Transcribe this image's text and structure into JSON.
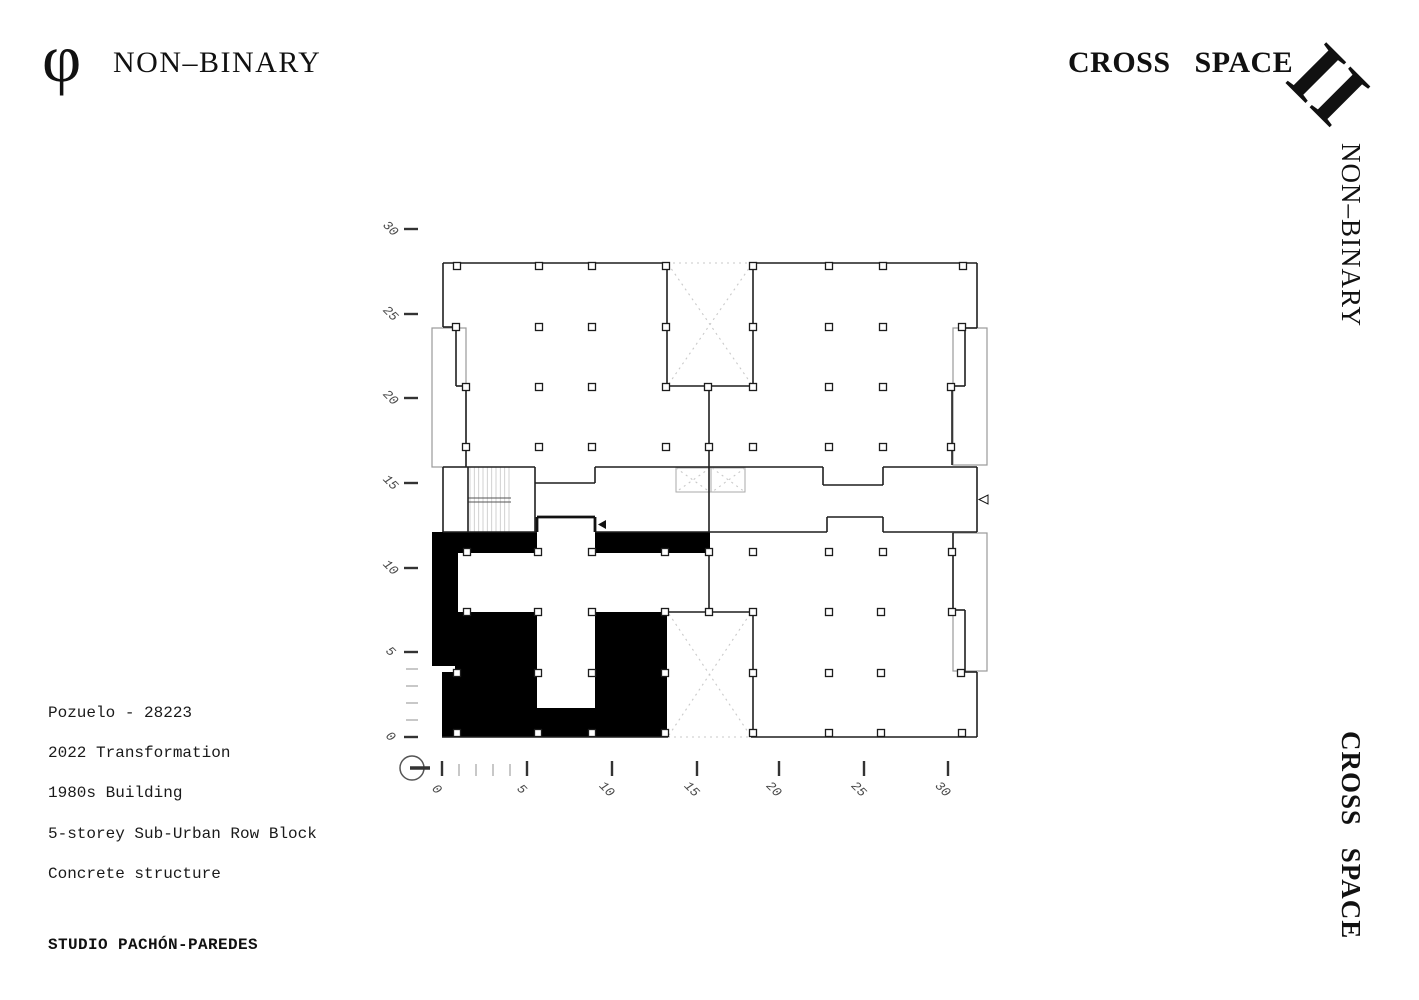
{
  "page": {
    "width": 1419,
    "height": 1000,
    "background": "#ffffff"
  },
  "branding": {
    "logo_glyph": "φ",
    "title_left": "NON–BINARY",
    "title_right": "CROSS SPACE",
    "floor_numeral": "II",
    "side_top": "NON–BINARY",
    "side_bottom": "CROSS SPACE"
  },
  "project_info": {
    "lines": [
      "Pozuelo - 28223",
      "2022 Transformation",
      "1980s Building",
      "5-storey Sub-Urban Row Block",
      "Concrete structure"
    ],
    "studio": "STUDIO PACHÓN-PAREDES"
  },
  "colors": {
    "wall_dark": "#1f1f1f",
    "fill_black": "#000000",
    "bay_gray": "#9a9a9a",
    "light_gray": "#c9c9c9",
    "hatch_gray": "#cccccc",
    "tick_dark": "#333333",
    "tick_minor": "#bbbbbb",
    "label_gray": "#4a4a4a"
  },
  "axes": {
    "left": {
      "values": [
        "30",
        "25",
        "20",
        "15",
        "10",
        "5",
        "0"
      ],
      "y": [
        229,
        314,
        398,
        483,
        568,
        652,
        737
      ],
      "minor_y": [
        669,
        686,
        703,
        720
      ],
      "dash_x1": 404,
      "dash_x2": 418,
      "label_x": 390
    },
    "bottom": {
      "values": [
        "0",
        "5",
        "10",
        "15",
        "20",
        "25",
        "30"
      ],
      "x": [
        442,
        527,
        612,
        697,
        779,
        864,
        948
      ],
      "minor_x": [
        459,
        476,
        493,
        510
      ],
      "dash_y1": 761,
      "dash_y2": 776,
      "label_y": 793
    }
  },
  "plan": {
    "fills_black": [
      [
        432,
        532,
        26,
        134
      ],
      [
        443,
        532,
        94,
        21
      ],
      [
        595,
        532,
        115,
        21
      ],
      [
        455,
        612,
        82,
        60
      ],
      [
        595,
        612,
        72,
        60
      ],
      [
        442,
        672,
        95,
        36
      ],
      [
        595,
        672,
        72,
        36
      ],
      [
        442,
        708,
        225,
        29
      ]
    ],
    "bay_rects": [
      [
        432,
        328,
        34,
        139
      ],
      [
        953,
        328,
        34,
        137
      ],
      [
        953,
        533,
        34,
        138
      ]
    ],
    "elevator": {
      "rect": [
        676,
        468,
        69,
        24
      ],
      "mid_x": 711
    },
    "stairs": {
      "x1": 470,
      "x2": 509,
      "n": 10,
      "y1": 467,
      "y2": 532,
      "landing_y": [
        498,
        502
      ],
      "edge_x": 468,
      "right_x": 511
    },
    "walls_dark": [
      [
        443,
        263,
        667,
        263
      ],
      [
        753,
        263,
        977,
        263
      ],
      [
        443,
        263,
        443,
        327
      ],
      [
        443,
        327,
        456,
        327
      ],
      [
        456,
        327,
        456,
        386
      ],
      [
        456,
        386,
        466,
        386
      ],
      [
        466,
        386,
        466,
        467
      ],
      [
        977,
        263,
        977,
        328
      ],
      [
        977,
        328,
        965,
        328
      ],
      [
        965,
        328,
        965,
        386
      ],
      [
        965,
        386,
        952,
        386
      ],
      [
        952,
        386,
        952,
        465
      ],
      [
        667,
        263,
        667,
        386
      ],
      [
        753,
        263,
        753,
        386
      ],
      [
        667,
        386,
        753,
        386
      ],
      [
        709,
        386,
        709,
        532
      ],
      [
        443,
        467,
        535,
        467
      ],
      [
        535,
        467,
        535,
        532
      ],
      [
        535,
        483,
        595,
        483
      ],
      [
        595,
        467,
        595,
        483
      ],
      [
        595,
        467,
        823,
        467
      ],
      [
        823,
        467,
        823,
        485
      ],
      [
        823,
        485,
        883,
        485
      ],
      [
        883,
        467,
        883,
        485
      ],
      [
        883,
        467,
        977,
        467
      ],
      [
        443,
        467,
        443,
        532
      ],
      [
        977,
        467,
        977,
        532
      ],
      [
        468,
        467,
        468,
        532
      ],
      [
        443,
        532,
        537,
        532
      ],
      [
        595,
        532,
        827,
        532
      ],
      [
        883,
        532,
        977,
        532
      ],
      [
        827,
        532,
        827,
        517
      ],
      [
        827,
        517,
        883,
        517
      ],
      [
        883,
        517,
        883,
        532
      ],
      [
        709,
        553,
        709,
        612
      ],
      [
        667,
        612,
        753,
        612
      ],
      [
        753,
        612,
        753,
        737
      ],
      [
        751,
        737,
        977,
        737
      ],
      [
        953,
        533,
        953,
        610
      ],
      [
        953,
        610,
        965,
        610
      ],
      [
        965,
        610,
        965,
        672
      ],
      [
        965,
        672,
        977,
        672
      ],
      [
        977,
        672,
        977,
        737
      ],
      [
        442,
        737,
        668,
        737
      ]
    ],
    "walls_thick": [
      [
        537,
        532,
        537,
        517
      ],
      [
        537,
        517,
        595,
        517
      ],
      [
        595,
        517,
        595,
        532
      ]
    ],
    "landing_lines": [
      [
        468,
        498,
        511,
        498
      ],
      [
        468,
        502,
        511,
        502
      ]
    ],
    "dotted_lines": [
      [
        667,
        263,
        753,
        263
      ],
      [
        668,
        264,
        752,
        385
      ],
      [
        752,
        264,
        668,
        385
      ],
      [
        669,
        614,
        750,
        735
      ],
      [
        750,
        614,
        669,
        735
      ],
      [
        668,
        737,
        751,
        737
      ],
      [
        676,
        468,
        710,
        492
      ],
      [
        710,
        468,
        676,
        492
      ],
      [
        712,
        468,
        745,
        492
      ],
      [
        745,
        468,
        712,
        492
      ]
    ],
    "column_rows": [
      {
        "y": 266,
        "x": [
          457,
          539,
          592,
          666,
          753,
          829,
          883,
          963
        ]
      },
      {
        "y": 327,
        "x": [
          456,
          539,
          592,
          666,
          753,
          829,
          883,
          962
        ]
      },
      {
        "y": 387,
        "x": [
          466,
          539,
          592,
          666,
          708,
          753,
          829,
          883,
          951
        ]
      },
      {
        "y": 447,
        "x": [
          466,
          539,
          592,
          666,
          709,
          753,
          829,
          883,
          951
        ]
      },
      {
        "y": 552,
        "x": [
          467,
          538,
          592,
          665,
          709,
          753,
          829,
          883,
          952
        ]
      },
      {
        "y": 612,
        "x": [
          467,
          538,
          592,
          665,
          709,
          753,
          829,
          881,
          952
        ]
      },
      {
        "y": 673,
        "x": [
          457,
          538,
          592,
          665,
          753,
          829,
          881,
          961
        ]
      },
      {
        "y": 733,
        "x": [
          457,
          538,
          592,
          665,
          753,
          829,
          881,
          962
        ]
      }
    ],
    "column_size": 7,
    "arrow_filled": [
      [
        606,
        520
      ],
      [
        606,
        529
      ],
      [
        598,
        524.5
      ]
    ],
    "arrow_outline": [
      [
        988,
        495
      ],
      [
        988,
        504
      ],
      [
        979,
        499.5
      ]
    ],
    "north_symbol": {
      "cx": 412,
      "cy": 768,
      "r": 12
    }
  }
}
